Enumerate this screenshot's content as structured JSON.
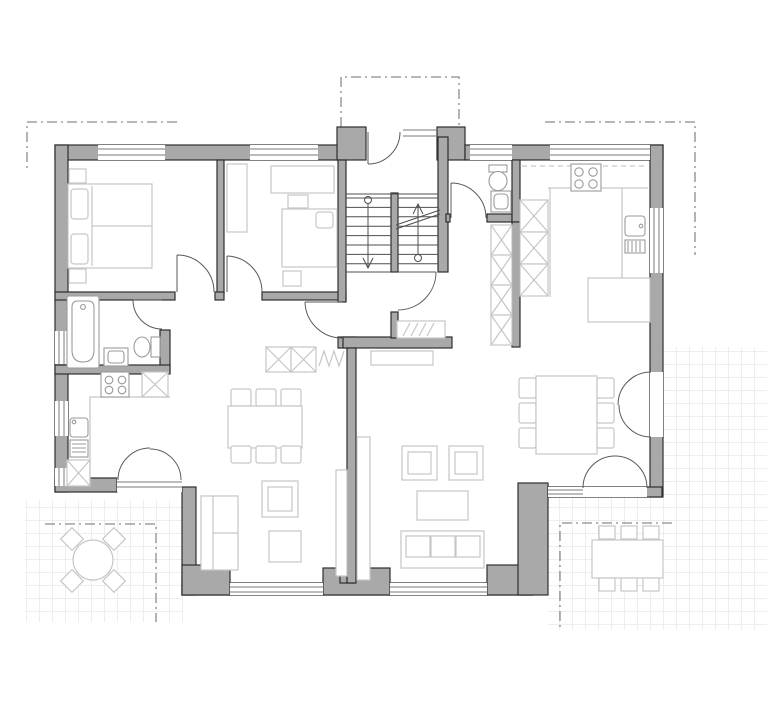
{
  "document": {
    "type": "architectural floor plan",
    "view": "top-down ground floor plan of a two-unit residential house",
    "visible_text": []
  },
  "colors": {
    "background": "#ffffff",
    "wall_fill": "#a9a9a9",
    "wall_outline": "#2e2e2e",
    "window_line": "#787878",
    "door_line": "#5a5a5a",
    "stair_line": "#4f4f4f",
    "furniture_line": "#c6c6c6",
    "fixture_line": "#9a9a9a",
    "tile_line": "#dedede",
    "overhang_line": "#8c8c8c"
  },
  "plan": {
    "shared": {
      "entrance": [
        "front door with glazed sidelight",
        "dash-dot canopy outline above entrance bay"
      ],
      "staircase": [
        "two flights with center spine wall",
        "walk lines with start circles and direction arrows",
        "diagonal break line"
      ]
    },
    "left_unit": {
      "bedroom": [
        "double bed with two pillows",
        "nightstand top",
        "nightstand bottom"
      ],
      "study_bedroom": [
        "wardrobe",
        "desk",
        "chair",
        "single bed with pillow",
        "nightstand"
      ],
      "bathroom": [
        "bathtub",
        "washbasin",
        "toilet"
      ],
      "kitchen": [
        "hob with 4 burners",
        "tall cabinet",
        "sink with drainboard",
        "base cabinet",
        "counter"
      ],
      "hall": [
        "two wardrobe cabinets",
        "coat rack zigzag symbol"
      ],
      "living_dining": [
        "dining table with 6 chairs",
        "sofa",
        "armchair",
        "ottoman",
        "shelf"
      ],
      "terrace": [
        "tiled paving",
        "round table",
        "4 chairs",
        "roof overhang dash-dot line"
      ]
    },
    "right_unit": {
      "wc": [
        "toilet",
        "washbasin"
      ],
      "kitchen": [
        "hob with 4 burners",
        "tall cabinets",
        "sink with drainboard",
        "counter with peninsula",
        "upper cabinets dashed line"
      ],
      "hall": [
        "wardrobe cabinet column",
        "radiator symbol"
      ],
      "living_dining": [
        "dining table with 6 chairs",
        "sofa",
        "two armchairs",
        "coffee table",
        "sideboard",
        "shelf",
        "double french door to side terrace",
        "double french door to rear terrace"
      ],
      "terrace": [
        "tiled paving",
        "rectangular table",
        "6 chairs",
        "roof overhang dash-dot line"
      ]
    },
    "annotations": [
      "dash-dot roof overhang lines at top-left and top-right corners"
    ]
  }
}
